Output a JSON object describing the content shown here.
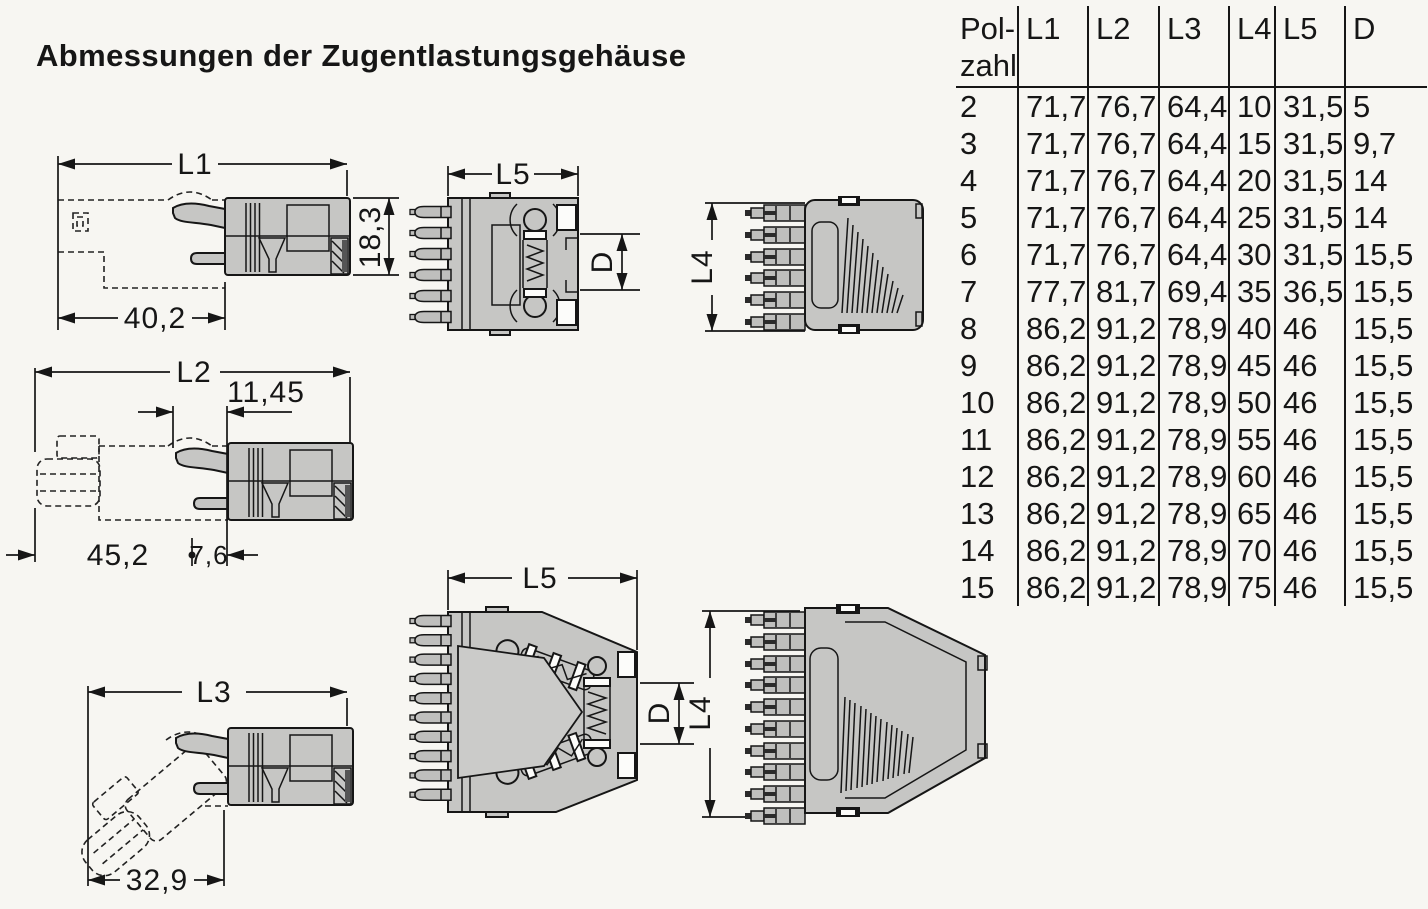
{
  "title": "Abmessungen der Zugentlastungsgehäuse",
  "colors": {
    "background": "#f7f6f2",
    "housing_fill": "#c6c6c4",
    "line": "#161616"
  },
  "table": {
    "pole_header_line1": "Pol-",
    "pole_header_line2": "zahl",
    "columns": [
      "L1",
      "L2",
      "L3",
      "L4",
      "L5",
      "D"
    ],
    "rows": [
      [
        "2",
        "71,7",
        "76,7",
        "64,4",
        "10",
        "31,5",
        "5"
      ],
      [
        "3",
        "71,7",
        "76,7",
        "64,4",
        "15",
        "31,5",
        "9,7"
      ],
      [
        "4",
        "71,7",
        "76,7",
        "64,4",
        "20",
        "31,5",
        "14"
      ],
      [
        "5",
        "71,7",
        "76,7",
        "64,4",
        "25",
        "31,5",
        "14"
      ],
      [
        "6",
        "71,7",
        "76,7",
        "64,4",
        "30",
        "31,5",
        "15,5"
      ],
      [
        "7",
        "77,7",
        "81,7",
        "69,4",
        "35",
        "36,5",
        "15,5"
      ],
      [
        "8",
        "86,2",
        "91,2",
        "78,9",
        "40",
        "46",
        "15,5"
      ],
      [
        "9",
        "86,2",
        "91,2",
        "78,9",
        "45",
        "46",
        "15,5"
      ],
      [
        "10",
        "86,2",
        "91,2",
        "78,9",
        "50",
        "46",
        "15,5"
      ],
      [
        "11",
        "86,2",
        "91,2",
        "78,9",
        "55",
        "46",
        "15,5"
      ],
      [
        "12",
        "86,2",
        "91,2",
        "78,9",
        "60",
        "46",
        "15,5"
      ],
      [
        "13",
        "86,2",
        "91,2",
        "78,9",
        "65",
        "46",
        "15,5"
      ],
      [
        "14",
        "86,2",
        "91,2",
        "78,9",
        "70",
        "46",
        "15,5"
      ],
      [
        "15",
        "86,2",
        "91,2",
        "78,9",
        "75",
        "46",
        "15,5"
      ]
    ]
  },
  "drawings": {
    "side_view_l1": {
      "overall_length": "L1",
      "housing_length": "40,2",
      "height": "18,3"
    },
    "front_view_small": {
      "width": "L5",
      "clamp_diameter": "D"
    },
    "top_view_small": {
      "pole_span": "L4"
    },
    "side_view_l2": {
      "overall_length": "L2",
      "latch_offset": "11,45",
      "housing_length": "45,2",
      "rear_offset": "7,6"
    },
    "side_view_l3": {
      "overall_length": "L3",
      "housing_length": "32,9"
    },
    "front_view_large": {
      "width": "L5",
      "clamp_diameter": "D"
    },
    "top_view_large": {
      "pole_span": "L4"
    }
  }
}
